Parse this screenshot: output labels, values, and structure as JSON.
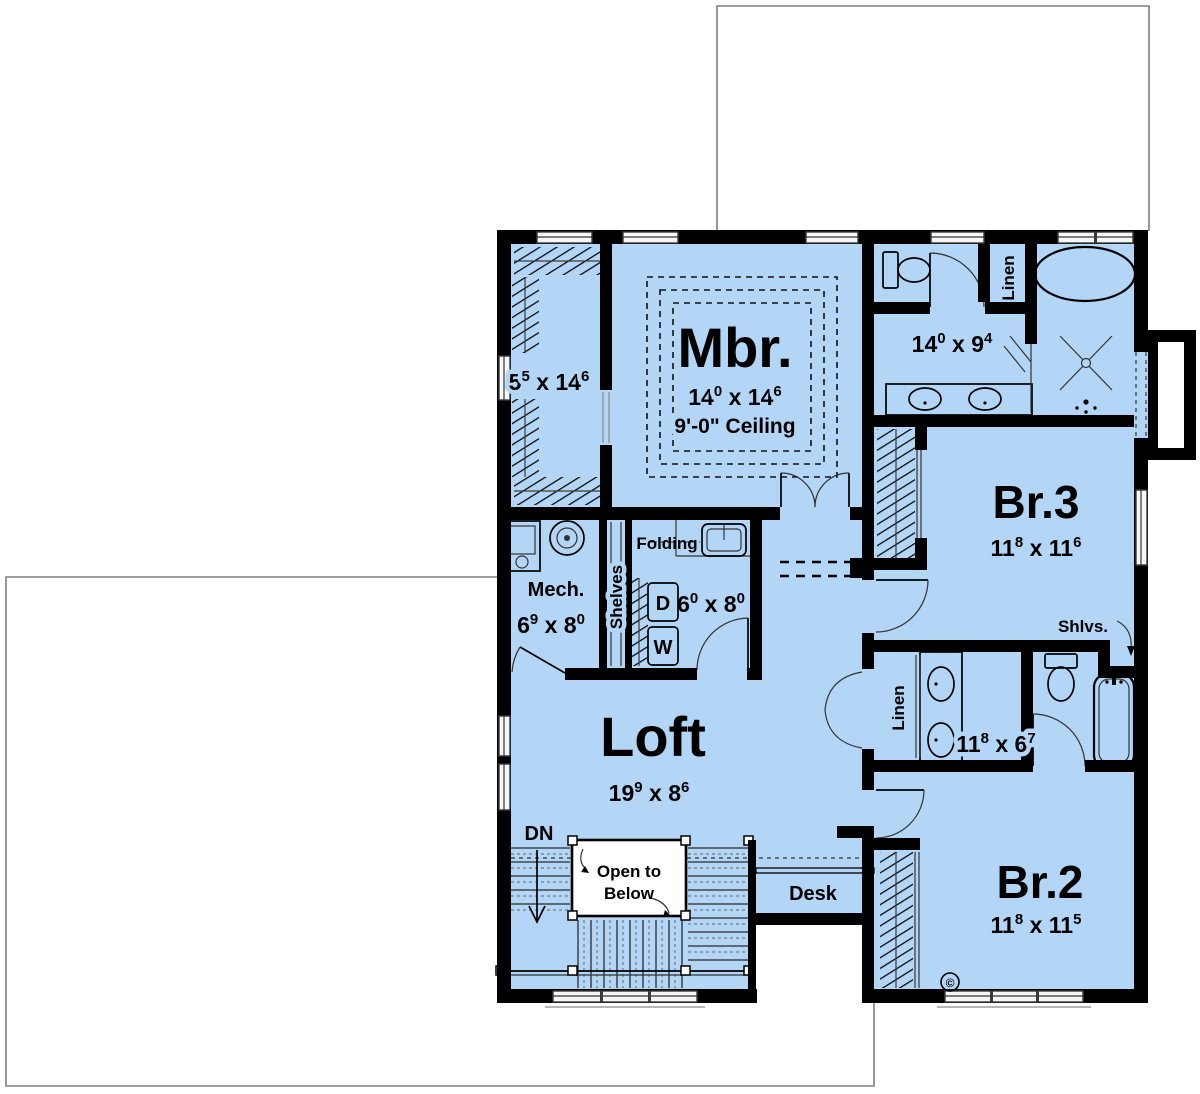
{
  "sep": " x ",
  "colors": {
    "floor": "#b3d6f7",
    "wall": "#000000",
    "lower_floor_outline": "#7f7f7f"
  },
  "rooms": {
    "master_closet": {
      "dim": {
        "a": "5",
        "a_sup": "5",
        "b": "14",
        "b_sup": "6"
      }
    },
    "master_bedroom": {
      "name": "Mbr.",
      "dim": {
        "a": "14",
        "a_sup": "0",
        "b": "14",
        "b_sup": "6"
      },
      "ceiling": "9'-0\" Ceiling"
    },
    "master_bath": {
      "dim": {
        "a": "14",
        "a_sup": "0",
        "b": "9",
        "b_sup": "4"
      },
      "linen": "Linen"
    },
    "bedroom_3": {
      "name": "Br.3",
      "dim": {
        "a": "11",
        "a_sup": "8",
        "b": "11",
        "b_sup": "6"
      }
    },
    "laundry": {
      "folding": "Folding",
      "dryer": "D",
      "washer": "W",
      "dim": {
        "a": "6",
        "a_sup": "0",
        "b": "8",
        "b_sup": "0"
      }
    },
    "shelves_closet": {
      "label": "Shelves"
    },
    "mechanical": {
      "name": "Mech.",
      "dim": {
        "a": "6",
        "a_sup": "9",
        "b": "8",
        "b_sup": "0"
      }
    },
    "loft": {
      "name": "Loft",
      "dim": {
        "a": "19",
        "a_sup": "9",
        "b": "8",
        "b_sup": "6"
      }
    },
    "hall_bath": {
      "dim": {
        "a": "11",
        "a_sup": "8",
        "b": "6",
        "b_sup": "7"
      },
      "linen": "Linen",
      "shelves": "Shlvs."
    },
    "bedroom_2": {
      "name": "Br.2",
      "dim": {
        "a": "11",
        "a_sup": "8",
        "b": "11",
        "b_sup": "5"
      }
    }
  },
  "stairs": {
    "down": "DN",
    "open_line1": "Open to",
    "open_line2": "Below"
  },
  "desk": {
    "label": "Desk"
  },
  "copyright": "©"
}
